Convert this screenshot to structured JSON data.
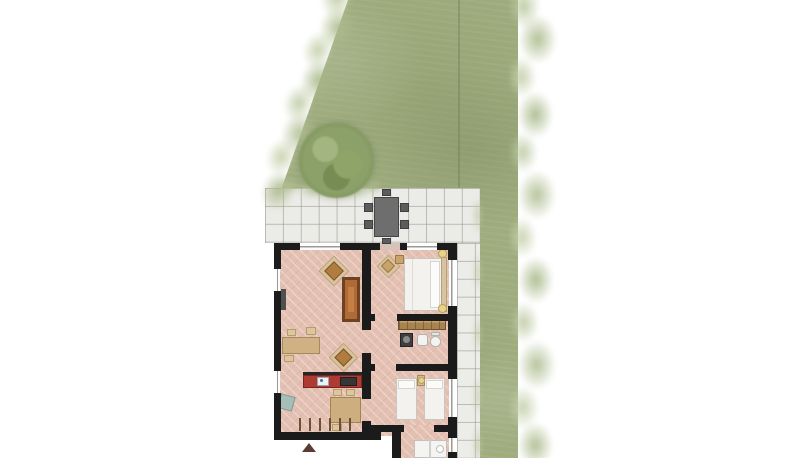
{
  "scene": {
    "width": 800,
    "height": 458,
    "background": "#ffffff",
    "description_elements": {
      "garden": "lawn-with-shrub-borders",
      "tree": "round-tree-top-view",
      "patio": "tiled-terrace",
      "walkway": "tiled-side-path",
      "house": "apartment-floor-plan-top-view"
    }
  },
  "palette": {
    "lawn": "#9fac7e",
    "shrub_light": "#c2cfa6",
    "tree": "#7e945c",
    "tile": "#ebebe7",
    "tile_line": "#94928a",
    "wall": "#1b1b1b",
    "floor": "#e3c0b2",
    "kitchen_counter": "#ae3a32",
    "wood": "#b06a38",
    "table_wood": "#ccae7f",
    "bed_linen": "#f3f2ee",
    "lamp": "#e8d28c",
    "patio_furniture": "#6e6e6e",
    "entrance_arrow": "#5e3c36"
  },
  "items": [
    {
      "name": "floor-main",
      "cls": "floor",
      "x": 277,
      "y": 246,
      "w": 174,
      "h": 190
    },
    {
      "name": "floor-utility",
      "cls": "floor",
      "x": 392,
      "y": 425,
      "w": 60,
      "h": 33
    },
    {
      "name": "patio-door-threshold",
      "x": 380,
      "y": 243,
      "w": 20,
      "h": 7,
      "fill": "#d8c2b7"
    },
    {
      "name": "living-armchair-mat",
      "x": 323,
      "y": 260,
      "w": 22,
      "h": 22,
      "fill": "#d9c2a0",
      "border": "#bfa379",
      "rot": 45
    },
    {
      "name": "living-armchair",
      "x": 327,
      "y": 264,
      "w": 14,
      "h": 14,
      "fill": "#b07c3f",
      "border": "#7d5526",
      "rot": 45
    },
    {
      "name": "cabinet-frame",
      "x": 342,
      "y": 277,
      "w": 18,
      "h": 45,
      "fill": "#6e4222"
    },
    {
      "name": "cabinet",
      "x": 345,
      "y": 280,
      "w": 12,
      "h": 39,
      "fill": "#b06a38"
    },
    {
      "name": "cabinet-shelf",
      "x": 348,
      "y": 287,
      "w": 6,
      "h": 25,
      "fill": "#c57f42"
    },
    {
      "name": "wall-shelf",
      "x": 281,
      "y": 289,
      "w": 5,
      "h": 21,
      "fill": "#4f4f4f"
    },
    {
      "name": "desk",
      "x": 282,
      "y": 337,
      "w": 38,
      "h": 17,
      "fill": "#cfb183",
      "border": "#a8895b"
    },
    {
      "name": "desk-chair-1",
      "x": 287,
      "y": 329,
      "w": 9,
      "h": 7,
      "fill": "#dbc69e",
      "border": "#b89c6c"
    },
    {
      "name": "desk-chair-2",
      "x": 306,
      "y": 327,
      "w": 10,
      "h": 8,
      "fill": "#dbc69e",
      "border": "#b89c6c"
    },
    {
      "name": "desk-chair-3",
      "x": 284,
      "y": 355,
      "w": 10,
      "h": 7,
      "fill": "#dbc69e",
      "border": "#b89c6c"
    },
    {
      "name": "living-chair2-mat",
      "x": 333,
      "y": 347,
      "w": 21,
      "h": 21,
      "fill": "#d9c2a0",
      "border": "#bfa379",
      "rot": 45
    },
    {
      "name": "living-chair2",
      "x": 337,
      "y": 351,
      "w": 13,
      "h": 13,
      "fill": "#b07c3f",
      "border": "#7d5526",
      "rot": 45
    },
    {
      "name": "kitchen-counter-edge",
      "x": 303,
      "y": 372,
      "w": 59,
      "h": 3,
      "fill": "#262626"
    },
    {
      "name": "kitchen-counter",
      "x": 303,
      "y": 375,
      "w": 59,
      "h": 13,
      "fill": "#ae3a32",
      "border": "#7c231d"
    },
    {
      "name": "kitchen-sink",
      "x": 317,
      "y": 377,
      "w": 12,
      "h": 9,
      "fill": "#edf1f3",
      "border": "#97a8b5"
    },
    {
      "name": "kitchen-faucet",
      "cls": "circle",
      "x": 320,
      "y": 379,
      "w": 3,
      "h": 3,
      "fill": "#3f6fa8"
    },
    {
      "name": "cooktop",
      "x": 340,
      "y": 377,
      "w": 17,
      "h": 9,
      "fill": "#363636",
      "border": "#1f1f1f"
    },
    {
      "name": "armchair-blue",
      "x": 279,
      "y": 395,
      "w": 15,
      "h": 15,
      "fill": "#a7bdb7",
      "border": "#7f9a94",
      "rot": 15
    },
    {
      "name": "dining-table",
      "x": 330,
      "y": 397,
      "w": 31,
      "h": 26,
      "fill": "#ccae7f",
      "border": "#a0854f"
    },
    {
      "name": "dining-chair-1",
      "x": 333,
      "y": 389,
      "w": 9,
      "h": 7,
      "fill": "#dbc69e",
      "border": "#b89c6c"
    },
    {
      "name": "dining-chair-2",
      "x": 346,
      "y": 389,
      "w": 9,
      "h": 7,
      "fill": "#dbc69e",
      "border": "#b89c6c"
    },
    {
      "name": "dining-chair-3",
      "x": 332,
      "y": 424,
      "w": 10,
      "h": 7,
      "fill": "#dbc69e",
      "border": "#b89c6c"
    },
    {
      "name": "window-tick-1",
      "x": 299,
      "y": 418,
      "w": 2,
      "h": 13,
      "fill": "#6a5136"
    },
    {
      "name": "window-tick-2",
      "x": 309,
      "y": 418,
      "w": 2,
      "h": 13,
      "fill": "#6a5136"
    },
    {
      "name": "window-tick-3",
      "x": 319,
      "y": 418,
      "w": 2,
      "h": 13,
      "fill": "#6a5136"
    },
    {
      "name": "window-tick-4",
      "x": 329,
      "y": 418,
      "w": 2,
      "h": 13,
      "fill": "#6a5136"
    },
    {
      "name": "window-tick-5",
      "x": 339,
      "y": 418,
      "w": 2,
      "h": 13,
      "fill": "#6a5136"
    },
    {
      "name": "window-tick-6",
      "x": 349,
      "y": 418,
      "w": 2,
      "h": 13,
      "fill": "#6a5136"
    },
    {
      "name": "bedroom1-chair-mat",
      "x": 380,
      "y": 258,
      "w": 17,
      "h": 17,
      "fill": "#d9c2a0",
      "border": "#bfa379",
      "rot": 45
    },
    {
      "name": "bedroom1-chair",
      "x": 383,
      "y": 261,
      "w": 10,
      "h": 10,
      "fill": "#c8a36b",
      "border": "#9b7a45",
      "rot": 45
    },
    {
      "name": "bedroom1-side-table",
      "x": 395,
      "y": 255,
      "w": 9,
      "h": 9,
      "fill": "#c8a36b",
      "border": "#9b7a45"
    },
    {
      "name": "double-bed",
      "x": 404,
      "y": 258,
      "w": 42,
      "h": 53,
      "fill": "#f3f2ee",
      "border": "#c9c6c0"
    },
    {
      "name": "double-bed-fold",
      "x": 412,
      "y": 259,
      "w": 1,
      "h": 51,
      "fill": "#dfdcd5"
    },
    {
      "name": "double-bed-pillows",
      "x": 430,
      "y": 261,
      "w": 10,
      "h": 47,
      "fill": "#fbfbf9",
      "border": "#d8d5cf"
    },
    {
      "name": "headboard",
      "x": 441,
      "y": 257,
      "w": 6,
      "h": 55,
      "fill": "#d6c49e",
      "border": "#b3a076"
    },
    {
      "name": "nightstand-lamp-1",
      "cls": "circle",
      "x": 438,
      "y": 249,
      "w": 9,
      "h": 9,
      "fill": "#e8d28c",
      "border": "#b7a057"
    },
    {
      "name": "nightstand-lamp-2",
      "cls": "circle",
      "x": 438,
      "y": 304,
      "w": 9,
      "h": 9,
      "fill": "#e8d28c",
      "border": "#b7a057"
    },
    {
      "name": "wardrobe",
      "cls": "wardrobe",
      "x": 398,
      "y": 316,
      "w": 48,
      "h": 14,
      "border": "#6f5330"
    },
    {
      "name": "washing-machine",
      "x": 400,
      "y": 333,
      "w": 13,
      "h": 14,
      "fill": "#3f3f3f",
      "border": "#242424"
    },
    {
      "name": "washing-machine-door",
      "cls": "circle",
      "x": 403,
      "y": 336,
      "w": 7,
      "h": 7,
      "fill": "#8a8a8a"
    },
    {
      "name": "bathroom-sink",
      "cls": "rounded",
      "x": 417,
      "y": 334,
      "w": 11,
      "h": 12,
      "fill": "#f3f3f1",
      "border": "#b3b3ae"
    },
    {
      "name": "toilet-tank",
      "x": 431,
      "y": 332,
      "w": 9,
      "h": 4,
      "fill": "#e4e4e0",
      "border": "#b3b3ae"
    },
    {
      "name": "toilet-bowl",
      "cls": "oval",
      "x": 430,
      "y": 336,
      "w": 11,
      "h": 11,
      "fill": "#f3f3f1",
      "border": "#b3b3ae"
    },
    {
      "name": "single-bed-1",
      "x": 396,
      "y": 378,
      "w": 21,
      "h": 42,
      "fill": "#f3f2ee",
      "border": "#c9c6c0"
    },
    {
      "name": "single-bed-1-pillow",
      "x": 398,
      "y": 380,
      "w": 17,
      "h": 9,
      "fill": "#fbfbf9",
      "border": "#d8d5cf"
    },
    {
      "name": "single-bed-2",
      "x": 424,
      "y": 378,
      "w": 21,
      "h": 42,
      "fill": "#f3f2ee",
      "border": "#c9c6c0"
    },
    {
      "name": "single-bed-2-pillow",
      "x": 426,
      "y": 380,
      "w": 17,
      "h": 9,
      "fill": "#fbfbf9",
      "border": "#d8d5cf"
    },
    {
      "name": "nightstand",
      "x": 417,
      "y": 375,
      "w": 8,
      "h": 11,
      "fill": "#d2bb8f",
      "border": "#a8895b"
    },
    {
      "name": "nightstand-lamp-3",
      "cls": "circle",
      "x": 418,
      "y": 377,
      "w": 7,
      "h": 7,
      "fill": "#e8d28c",
      "border": "#b7a057"
    },
    {
      "name": "shower-unit",
      "x": 414,
      "y": 440,
      "w": 33,
      "h": 18,
      "fill": "#f4f4f2",
      "border": "#c2c2bd"
    },
    {
      "name": "shower-divider",
      "x": 429,
      "y": 440,
      "w": 2,
      "h": 18,
      "fill": "#d0d0ca"
    },
    {
      "name": "utility-sink",
      "cls": "circle",
      "x": 436,
      "y": 445,
      "w": 8,
      "h": 8,
      "fill": "#ffffff",
      "border": "#bbbbb6"
    },
    {
      "name": "wall-top-1",
      "cls": "wall",
      "x": 274,
      "y": 243,
      "w": 26,
      "h": 7
    },
    {
      "name": "wall-top-2",
      "cls": "wall",
      "x": 340,
      "y": 243,
      "w": 40,
      "h": 7
    },
    {
      "name": "wall-top-3",
      "cls": "wall",
      "x": 400,
      "y": 243,
      "w": 7,
      "h": 7
    },
    {
      "name": "wall-top-4",
      "cls": "wall",
      "x": 437,
      "y": 243,
      "w": 20,
      "h": 7
    },
    {
      "name": "wall-left-1",
      "cls": "wall",
      "x": 274,
      "y": 243,
      "w": 7,
      "h": 26
    },
    {
      "name": "wall-left-2",
      "cls": "wall",
      "x": 274,
      "y": 291,
      "w": 7,
      "h": 80
    },
    {
      "name": "wall-left-3",
      "cls": "wall",
      "x": 274,
      "y": 393,
      "w": 7,
      "h": 47
    },
    {
      "name": "wall-bottom",
      "cls": "wall",
      "x": 274,
      "y": 432,
      "w": 107,
      "h": 8
    },
    {
      "name": "wall-mid-1",
      "cls": "wall",
      "x": 362,
      "y": 243,
      "w": 9,
      "h": 87
    },
    {
      "name": "wall-mid-2",
      "cls": "wall",
      "x": 362,
      "y": 353,
      "w": 9,
      "h": 46
    },
    {
      "name": "wall-mid-3",
      "cls": "wall",
      "x": 362,
      "y": 421,
      "w": 9,
      "h": 19
    },
    {
      "name": "wall-right-1",
      "cls": "wall",
      "x": 448,
      "y": 243,
      "w": 9,
      "h": 17
    },
    {
      "name": "wall-right-2",
      "cls": "wall",
      "x": 448,
      "y": 306,
      "w": 9,
      "h": 73
    },
    {
      "name": "wall-right-3",
      "cls": "wall",
      "x": 448,
      "y": 417,
      "w": 9,
      "h": 21
    },
    {
      "name": "wall-right-4",
      "cls": "wall",
      "x": 448,
      "y": 452,
      "w": 9,
      "h": 6
    },
    {
      "name": "wall-bath-a",
      "cls": "wall",
      "x": 371,
      "y": 314,
      "w": 4,
      "h": 7
    },
    {
      "name": "wall-bath-b",
      "cls": "wall",
      "x": 397,
      "y": 314,
      "w": 51,
      "h": 7
    },
    {
      "name": "wall-bath2-a",
      "cls": "wall",
      "x": 371,
      "y": 364,
      "w": 4,
      "h": 7
    },
    {
      "name": "wall-bath2-b",
      "cls": "wall",
      "x": 396,
      "y": 364,
      "w": 52,
      "h": 7
    },
    {
      "name": "wall-bed2-a",
      "cls": "wall",
      "x": 371,
      "y": 425,
      "w": 33,
      "h": 7
    },
    {
      "name": "wall-bed2-b",
      "cls": "wall",
      "x": 434,
      "y": 425,
      "w": 14,
      "h": 7
    },
    {
      "name": "wall-utility",
      "cls": "wall",
      "x": 392,
      "y": 432,
      "w": 9,
      "h": 26
    },
    {
      "name": "window-top-1",
      "cls": "win-h",
      "x": 300,
      "y": 244,
      "w": 40,
      "h": 5.5
    },
    {
      "name": "window-top-2",
      "cls": "win-h",
      "x": 407,
      "y": 244,
      "w": 30,
      "h": 5.5
    },
    {
      "name": "window-left-1",
      "cls": "win-v",
      "x": 274.5,
      "y": 269,
      "w": 5.5,
      "h": 22
    },
    {
      "name": "window-left-2",
      "cls": "win-v",
      "x": 274.5,
      "y": 371,
      "w": 5.5,
      "h": 22
    },
    {
      "name": "window-right-1",
      "cls": "win-v",
      "x": 449,
      "y": 260,
      "w": 5.5,
      "h": 46
    },
    {
      "name": "window-right-2",
      "cls": "win-v",
      "x": 449,
      "y": 379,
      "w": 5.5,
      "h": 38
    },
    {
      "name": "window-right-3",
      "cls": "win-v",
      "x": 449,
      "y": 438,
      "w": 5.5,
      "h": 14
    },
    {
      "name": "entrance-arrow",
      "cls": "tri-up",
      "x": 302,
      "y": 443,
      "w": 14,
      "h": 9,
      "fill": "#5e3c36"
    },
    {
      "name": "patio-table",
      "x": 374,
      "y": 197,
      "w": 25,
      "h": 40,
      "fill": "#6e6e6e",
      "border": "#454545"
    },
    {
      "name": "patio-chair-left-1",
      "x": 364,
      "y": 203,
      "w": 9,
      "h": 9,
      "fill": "#5c5c5c",
      "border": "#3f3f3f"
    },
    {
      "name": "patio-chair-left-2",
      "x": 364,
      "y": 220,
      "w": 9,
      "h": 9,
      "fill": "#5c5c5c",
      "border": "#3f3f3f"
    },
    {
      "name": "patio-chair-right-1",
      "x": 400,
      "y": 203,
      "w": 9,
      "h": 9,
      "fill": "#5c5c5c",
      "border": "#3f3f3f"
    },
    {
      "name": "patio-chair-right-2",
      "x": 400,
      "y": 220,
      "w": 9,
      "h": 9,
      "fill": "#5c5c5c",
      "border": "#3f3f3f"
    },
    {
      "name": "patio-chair-top",
      "x": 382,
      "y": 189,
      "w": 9,
      "h": 7,
      "fill": "#5c5c5c",
      "border": "#3f3f3f"
    },
    {
      "name": "patio-chair-bottom",
      "x": 382,
      "y": 238,
      "w": 9,
      "h": 6,
      "fill": "#5c5c5c",
      "border": "#3f3f3f"
    }
  ]
}
